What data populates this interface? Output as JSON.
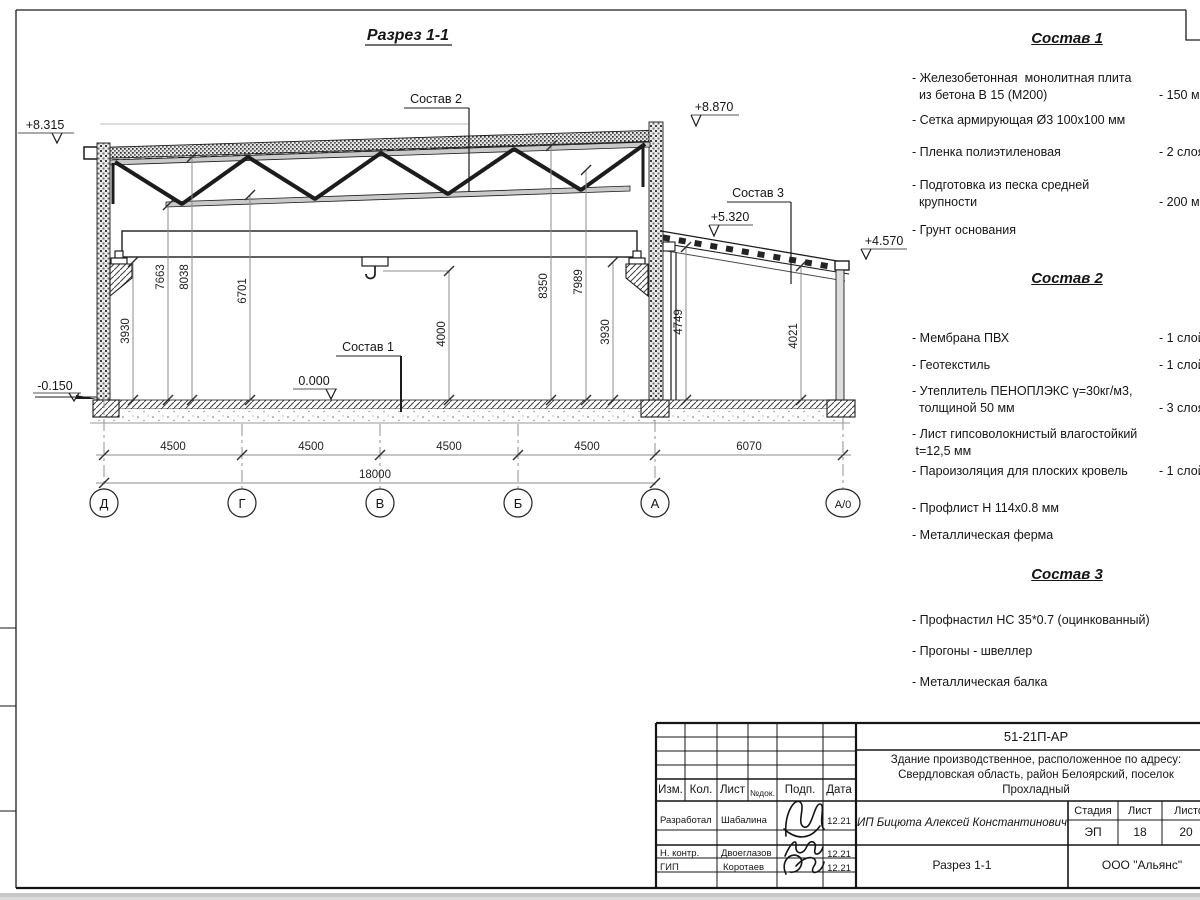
{
  "drawing": {
    "title": "Разрез 1-1",
    "leader_sostav1": "Состав 1",
    "leader_sostav2": "Состав 2",
    "leader_sostav3": "Состав 3",
    "elev_left": "+8.315",
    "elev_ridge": "+8.870",
    "elev_annex": "+5.320",
    "elev_annex_right": "+4.570",
    "elev_floor": "0.000",
    "elev_ground": "-0.150",
    "vdims": {
      "v1": "3930",
      "v2": "7663",
      "v3": "8038",
      "v4": "6701",
      "v5": "4000",
      "v6": "8350",
      "v7": "7989",
      "v8": "3930",
      "v9": "4749",
      "v10": "4021"
    },
    "hdims": {
      "s1": "4500",
      "s2": "4500",
      "s3": "4500",
      "s4": "4500",
      "s5": "6070",
      "total": "18000"
    },
    "axes": {
      "a1": "Д",
      "a2": "Г",
      "a3": "В",
      "a4": "Б",
      "a5": "А",
      "a6": "А/0"
    }
  },
  "materials": {
    "list1": {
      "title": "Состав 1",
      "items": [
        {
          "text": "- Железобетонная  монолитная плита\n  из бетона В 15 (М200)",
          "value": "- 150 мм"
        },
        {
          "text": "- Сетка армирующая Ø3 100х100 мм",
          "value": ""
        },
        {
          "text": "- Пленка полиэтиленовая",
          "value": "- 2 слоя"
        },
        {
          "text": "- Подготовка из песка средней\n  крупности",
          "value": "- 200 мм"
        },
        {
          "text": "- Грунт основания",
          "value": ""
        }
      ]
    },
    "list2": {
      "title": "Состав 2",
      "items": [
        {
          "text": "- Мембрана ПВХ",
          "value": "- 1 слой"
        },
        {
          "text": "- Геотекстиль",
          "value": "- 1 слой"
        },
        {
          "text": "- Утеплитель ПЕНОПЛЭКС γ=30кг/м3,\n  толщиной 50 мм",
          "value": "- 3 слоя"
        },
        {
          "text": "- Лист гипсоволокнистый влагостойкий\n t=12,5 мм",
          "value": ""
        },
        {
          "text": "- Пароизоляция для плоских кровель",
          "value": "- 1 слой"
        },
        {
          "text": "- Профлист Н 114х0.8 мм",
          "value": ""
        },
        {
          "text": "- Металлическая ферма",
          "value": ""
        }
      ]
    },
    "list3": {
      "title": "Состав 3",
      "items": [
        {
          "text": "- Профнастил НС 35*0.7 (оцинкованный)",
          "value": ""
        },
        {
          "text": "- Прогоны - швеллер",
          "value": ""
        },
        {
          "text": "- Металлическая балка",
          "value": ""
        }
      ]
    }
  },
  "titleblock": {
    "doc_number": "51-21П-АР",
    "project": "Здание производственное, расположенное по адресу:\nСвердловская область, район Белоярский, поселок\nПрохладный",
    "client": "ИП Бицюта Алексей Константинович",
    "sheet_title": "Разрез 1-1",
    "company": "ООО \"Альянс\"",
    "cols": {
      "izm": "Изм.",
      "kol": "Кол.",
      "list": "Лист",
      "ndok": "№док.",
      "podp": "Подп.",
      "data": "Дата"
    },
    "stage": {
      "label": "Стадия",
      "value": "ЭП"
    },
    "sheet_no": {
      "label": "Лист",
      "value": "18"
    },
    "sheet_total": {
      "label": "Листов",
      "value": "20"
    },
    "rows": [
      {
        "role": "Разработал",
        "name": "Шабалина",
        "date": "12.21"
      },
      {
        "role": "Н. контр.",
        "name": "Двоеглазов",
        "date": "12.21"
      },
      {
        "role": "ГИП",
        "name": "Коротаев",
        "date": "12.21"
      }
    ]
  }
}
